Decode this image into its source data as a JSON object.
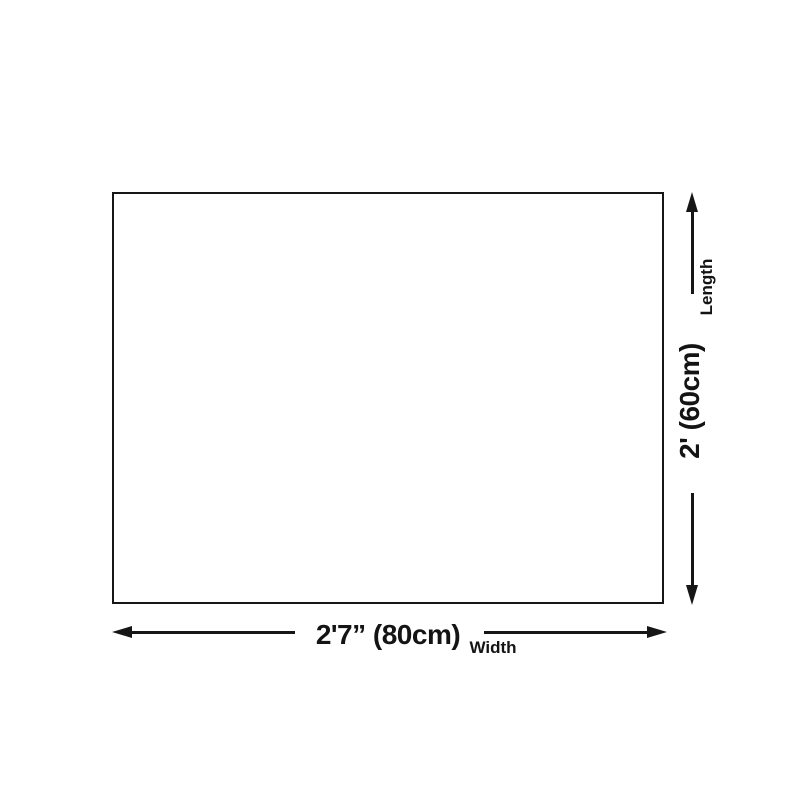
{
  "diagram": {
    "type": "product-size-diagram",
    "background_color": "#ffffff",
    "line_color": "#161616",
    "text_color": "#141414",
    "product_box": {
      "fill": "#ffffff",
      "border_color": "#161616"
    },
    "width_dimension": {
      "value": "2'7” (80cm)",
      "label": "Width"
    },
    "length_dimension": {
      "value": "2' (60cm)",
      "label": "Length"
    }
  }
}
